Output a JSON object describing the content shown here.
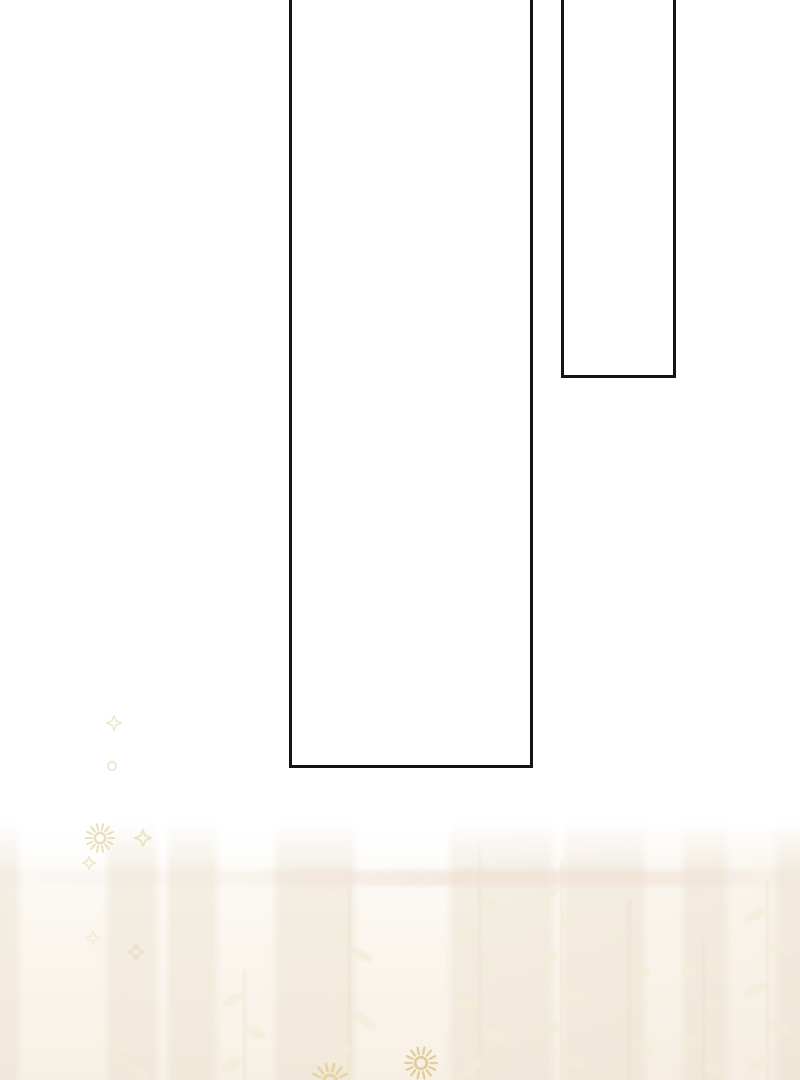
{
  "page": {
    "kind": "webtoon-comic-page",
    "background_color": "#ffffff",
    "visible_text": []
  },
  "panels": [
    {
      "name": "tall-empty-panel",
      "description": "large empty vertical panel, open at top edge",
      "left": 289,
      "top": -8,
      "width": 244,
      "height": 776,
      "border_width": 3,
      "border_color": "#141414",
      "fill": "#ffffff"
    },
    {
      "name": "narrow-empty-panel",
      "description": "narrow empty vertical panel, open at top edge",
      "left": 561,
      "top": -8,
      "width": 115,
      "height": 386,
      "border_width": 3,
      "border_color": "#141414",
      "fill": "#ffffff"
    }
  ],
  "bottom_scene": {
    "description": "faint cream curtain backdrop with vertical stripes, soft horizontal light band and pale leaf silhouettes fading up into white",
    "stripe_color": "rgba(233,222,204,0.50)",
    "band_color": "rgba(238,221,209,0.55)",
    "leaf_light_color": "#f3edd9",
    "leaf_dark_color": "#e9dfc5",
    "base_top_color": "#fcf9f3",
    "base_bottom_color": "#f6efe3"
  },
  "sparkles": [
    {
      "type": "diamond",
      "x": 114,
      "y": 723,
      "size": 17,
      "color": "#ecead0",
      "opacity": 0.95
    },
    {
      "type": "ring",
      "x": 112,
      "y": 766,
      "size": 14,
      "color": "#ebe8cb",
      "opacity": 0.9
    },
    {
      "type": "sunburst",
      "x": 100,
      "y": 838,
      "size": 32,
      "color": "#e6e1b9",
      "opacity": 0.95
    },
    {
      "type": "diamond",
      "x": 143,
      "y": 838,
      "size": 19,
      "color": "#e8e3c0",
      "opacity": 0.9
    },
    {
      "type": "diamond",
      "x": 89,
      "y": 863,
      "size": 15,
      "color": "#eae6c6",
      "opacity": 0.85
    },
    {
      "type": "diamond",
      "x": 93,
      "y": 938,
      "size": 16,
      "color": "#efead2",
      "opacity": 0.75
    },
    {
      "type": "diamond",
      "x": 136,
      "y": 952,
      "size": 18,
      "color": "#e9dfc2",
      "opacity": 0.85
    },
    {
      "type": "sunburst",
      "x": 421,
      "y": 1063,
      "size": 36,
      "color": "#e2cd97",
      "opacity": 0.95
    },
    {
      "type": "sunburst",
      "x": 330,
      "y": 1082,
      "size": 42,
      "color": "#e5d2a0",
      "opacity": 0.9
    }
  ]
}
